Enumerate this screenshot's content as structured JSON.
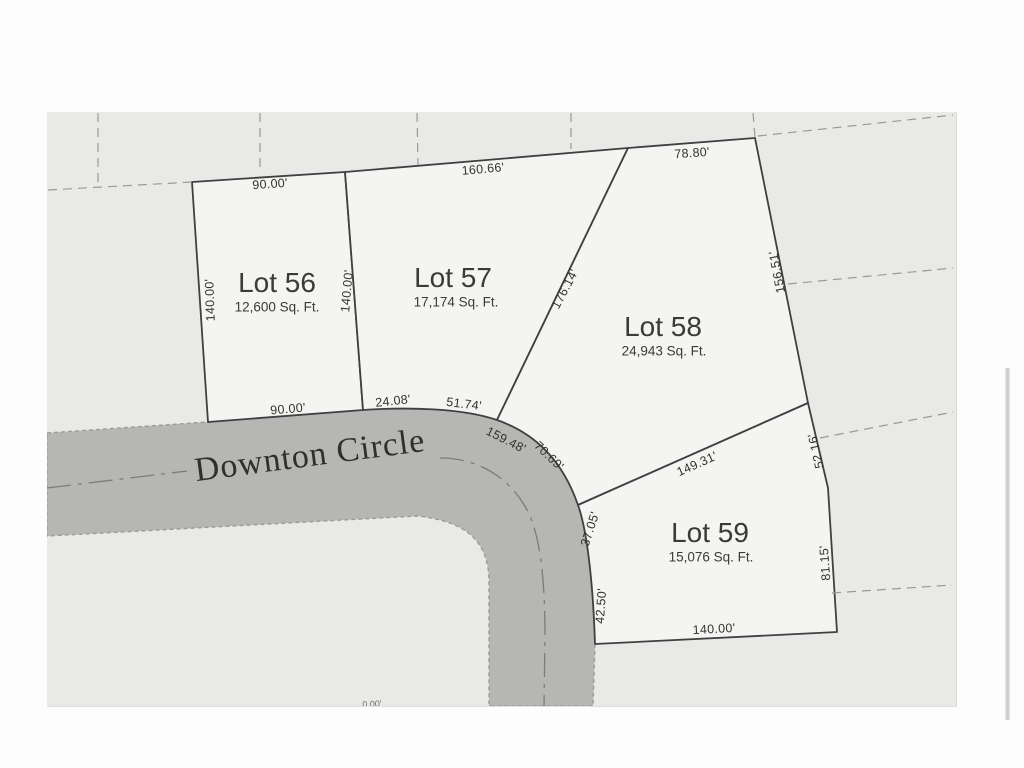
{
  "street": {
    "name": "Downton Circle"
  },
  "lots": [
    {
      "name": "Lot 56",
      "area": "12,600 Sq. Ft."
    },
    {
      "name": "Lot 57",
      "area": "17,174 Sq. Ft."
    },
    {
      "name": "Lot 58",
      "area": "24,943 Sq. Ft."
    },
    {
      "name": "Lot 59",
      "area": "15,076 Sq. Ft."
    }
  ],
  "dims": {
    "lot56_top": "90.00'",
    "lot56_left": "140.00'",
    "lot56_right": "140.00'",
    "lot56_bottom": "90.00'",
    "lot57_top": "160.66'",
    "lot57_diagonal": "176.14'",
    "lot58_top": "78.80'",
    "lot58_right": "156.51'",
    "front_a": "24.08'",
    "front_b": "51.74'",
    "arc_inner": "159.48'",
    "arc_lot58": "70.69'",
    "lot58_59_boundary": "149.31'",
    "lot59_right_upper": "52.16'",
    "lot59_right_lower": "81.15'",
    "arc_lot59_upper": "37.05'",
    "arc_lot59_lower": "42.50'",
    "lot59_bottom": "140.00'",
    "clipped_bottom": "0.00'"
  },
  "colors": {
    "page_background": "#e9e9e7",
    "lot_fill": "#f4f4f2",
    "road_fill": "#b6b6b4",
    "boundary_line": "#404040"
  }
}
